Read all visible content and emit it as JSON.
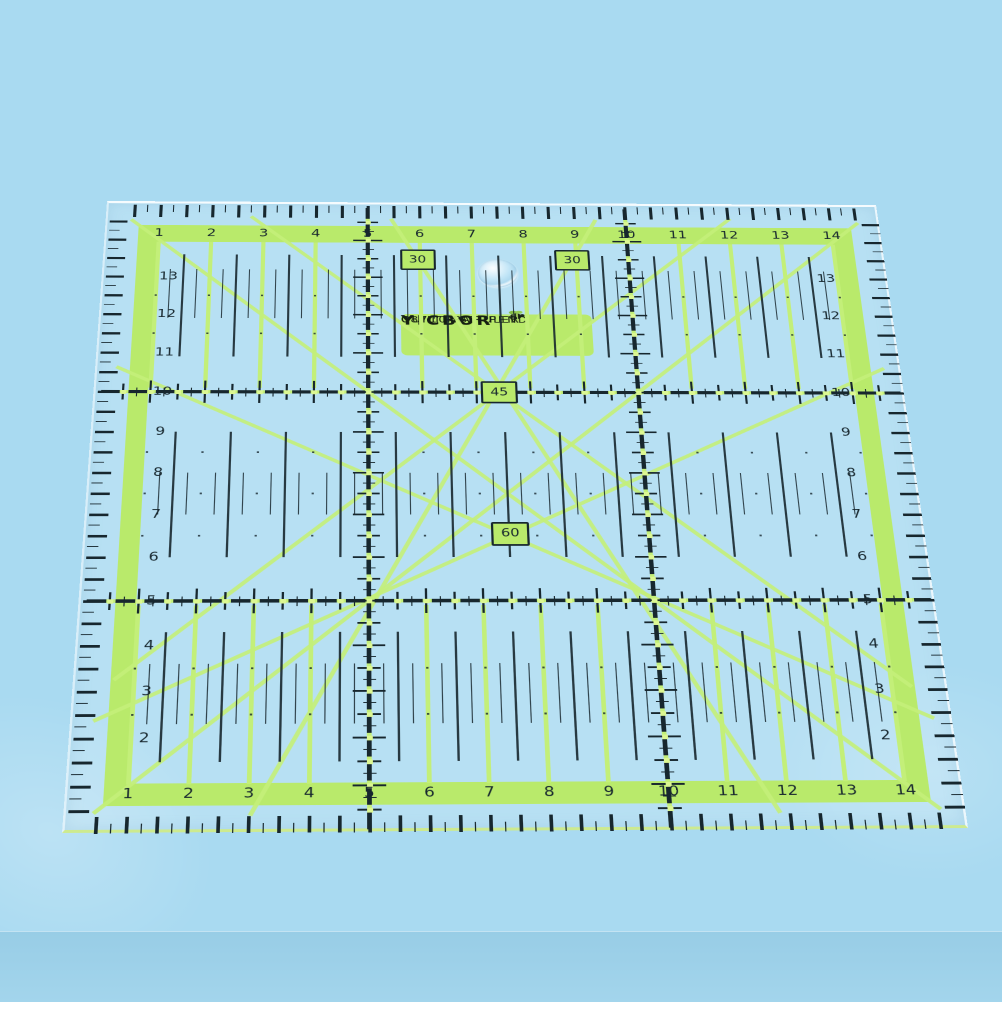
{
  "scene": {
    "background": "#a9daf1",
    "surface": "table surface with soft shadow line near bottom"
  },
  "ruler": {
    "type": "square transparent quilting ruler, perspective view",
    "brand_label": {
      "brand": "YICBOR",
      "line2": "QUILTING RULER",
      "line3": "08710   PAT. PEND",
      "icon": "bee-icon"
    },
    "angle_markers": [
      {
        "value": "30",
        "slot": "upper-left"
      },
      {
        "value": "30",
        "slot": "upper-right"
      },
      {
        "value": "45",
        "slot": "center-row10"
      },
      {
        "value": "60",
        "slot": "center-row6"
      }
    ],
    "scales": {
      "top": [
        "1",
        "2",
        "3",
        "4",
        "5",
        "6",
        "7",
        "8",
        "9",
        "10",
        "11",
        "12",
        "13",
        "14"
      ],
      "bottom": [
        "1",
        "2",
        "3",
        "4",
        "5",
        "6",
        "7",
        "8",
        "9",
        "10",
        "11",
        "12",
        "13",
        "14"
      ],
      "left": [
        "13",
        "12",
        "11",
        "10",
        "9",
        "8",
        "7",
        "6",
        "5",
        "4",
        "3",
        "2"
      ],
      "right": [
        "13",
        "12",
        "11",
        "10",
        "9",
        "8",
        "7",
        "6",
        "5",
        "4",
        "3",
        "2"
      ]
    },
    "colors": {
      "band_green": "#b9ea6b",
      "line_green": "#c3ef79",
      "dot_green": "#dcf792",
      "ink": "#17272e",
      "bottom_edge_green": "#cdea8f",
      "background_blue": "#a9daf1"
    }
  }
}
